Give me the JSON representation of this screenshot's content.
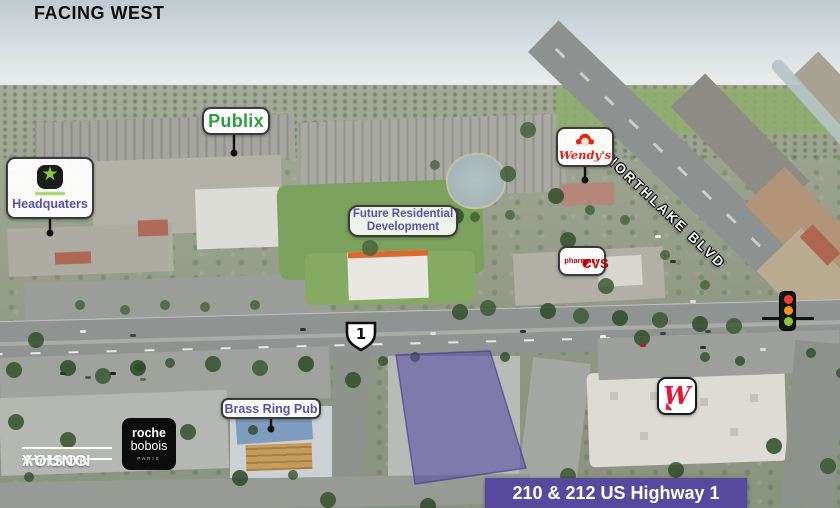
{
  "view": {
    "heading": "FACING WEST"
  },
  "map": {
    "street": "NORTHLAKE BLVD",
    "highway_shield": "1"
  },
  "callouts": {
    "publix": {
      "label": "Publix"
    },
    "headquarters": {
      "label": "Headquaters"
    },
    "wendys": {
      "label": "Wendy's"
    },
    "future_residential": {
      "line1": "Future Residential",
      "line2": "Development"
    },
    "cvs": {
      "heart": "♥",
      "name": "CVS",
      "sub": "pharmacy"
    },
    "brass_ring_pub": {
      "label": "Brass Ring Pub"
    },
    "roche_bobois": {
      "line1": "roche",
      "line2": "bobois",
      "line3": "PARIS"
    },
    "walgreens": {
      "initial": "W"
    }
  },
  "subject_property": {
    "banner": "210 & 212 US Highway 1"
  },
  "branding": {
    "broker_line1": "AVISON",
    "broker_line2": "YOUNG"
  },
  "colors": {
    "accent_purple": "#574a9e",
    "label_text_purple": "#5a50a5",
    "publix_green": "#2e9e41",
    "cvs_red": "#c00000",
    "wendys_red": "#e2231a",
    "walgreens_red": "#e31837",
    "parcel_fill": "rgba(88,74,165,0.58)"
  }
}
